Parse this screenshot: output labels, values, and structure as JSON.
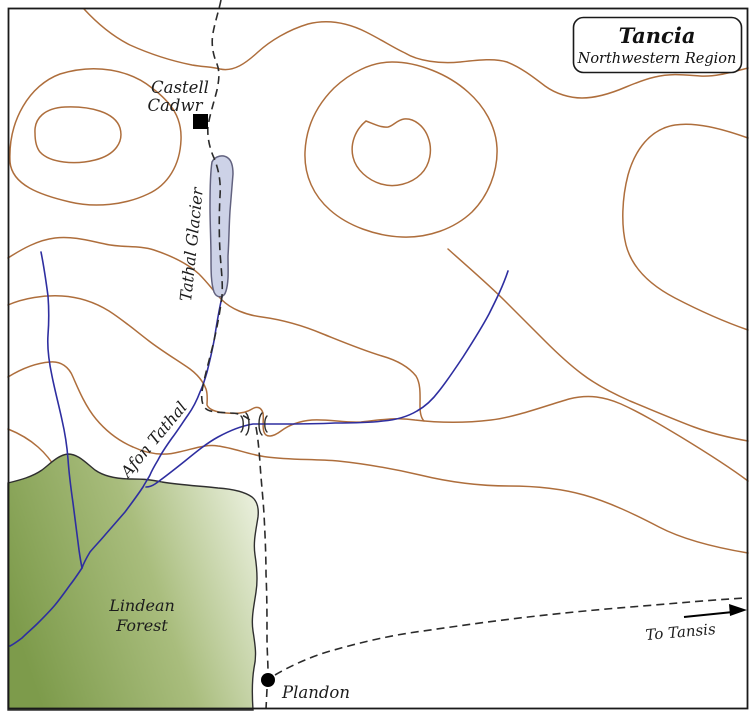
{
  "map": {
    "title": {
      "name": "Tancia",
      "subtitle": "Northwestern Region"
    },
    "labels": {
      "castle_line1": "Castell",
      "castle_line2": "Cadwr",
      "glacier": "Tathal Glacier",
      "river": "Afon Tathal",
      "forest_line1": "Lindean",
      "forest_line2": "Forest",
      "town": "Plandon",
      "route": "To Tansis"
    },
    "colors": {
      "contour": "#ae6e3c",
      "river": "#2e2ea0",
      "road": "#2b2b2b",
      "glacier_fill": "#cdd2e7",
      "glacier_stroke": "#62627f",
      "forest_dark": "#7d9b4b",
      "forest_mid": "#a9bd7d",
      "forest_light": "#e8eeda",
      "forest_outline": "#2f2f2f",
      "marker": "#000000",
      "border": "#1a1a1a"
    }
  }
}
